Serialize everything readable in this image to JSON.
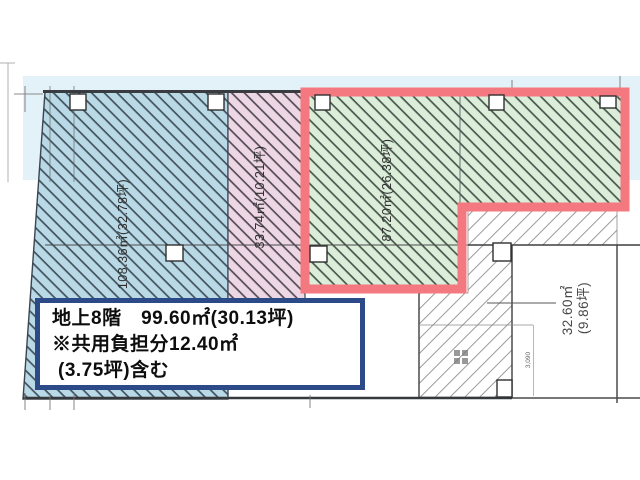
{
  "plan": {
    "info_box": {
      "line1": "地上8階　99.60㎡(30.13坪)",
      "line2": "※共用負担分12.40㎡",
      "line3": "(3.75坪)含む"
    },
    "areas": {
      "blue": {
        "area_label": "108.36㎡(32.78坪)",
        "fill": "#b9d9e6"
      },
      "pink": {
        "area_label": "33.74㎡(10.21坪)",
        "fill": "#eed7e5"
      },
      "green": {
        "area_label": "87.20㎡(26.38坪)",
        "fill": "#dcedda",
        "outline_color": "#f4787f"
      },
      "common_right": {
        "label_line1": "32.60㎡",
        "label_line2": "(9.86坪)"
      }
    },
    "dimension_note": "3,090",
    "colors": {
      "top_band": "#e3f1f8",
      "info_box_border": "#2c4a87",
      "hatch_blue_line": "#42525e",
      "hatch_pink_line": "#544b58",
      "hatch_green_line": "#47594c"
    }
  }
}
